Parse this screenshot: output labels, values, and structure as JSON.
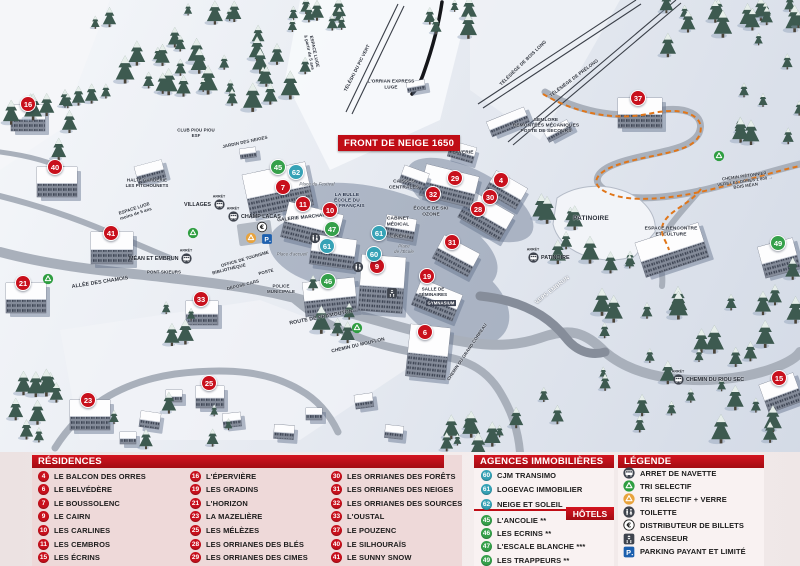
{
  "colors": {
    "residence": "#c8101c",
    "hotel": "#35a04a",
    "agency": "#36a2b6",
    "banner_red": "#c00d16",
    "parking_blue": "#1c5fae"
  },
  "map": {
    "banner": "FRONT DE NEIGE 1650",
    "bus_stop_microlabel": "ARRÊT",
    "markers": [
      {
        "n": "16",
        "t": "r",
        "x": 28,
        "y": 104
      },
      {
        "n": "40",
        "t": "r",
        "x": 55,
        "y": 167
      },
      {
        "n": "41",
        "t": "r",
        "x": 111,
        "y": 233
      },
      {
        "n": "21",
        "t": "r",
        "x": 23,
        "y": 283
      },
      {
        "n": "33",
        "t": "r",
        "x": 201,
        "y": 299
      },
      {
        "n": "23",
        "t": "r",
        "x": 88,
        "y": 400
      },
      {
        "n": "25",
        "t": "r",
        "x": 209,
        "y": 383
      },
      {
        "n": "7",
        "t": "r",
        "x": 283,
        "y": 187
      },
      {
        "n": "11",
        "t": "r",
        "x": 303,
        "y": 204
      },
      {
        "n": "10",
        "t": "r",
        "x": 330,
        "y": 210
      },
      {
        "n": "9",
        "t": "r",
        "x": 377,
        "y": 266
      },
      {
        "n": "32",
        "t": "r",
        "x": 433,
        "y": 194
      },
      {
        "n": "29",
        "t": "r",
        "x": 455,
        "y": 178
      },
      {
        "n": "4",
        "t": "r",
        "x": 501,
        "y": 180
      },
      {
        "n": "30",
        "t": "r",
        "x": 490,
        "y": 197
      },
      {
        "n": "28",
        "t": "r",
        "x": 478,
        "y": 209
      },
      {
        "n": "31",
        "t": "r",
        "x": 452,
        "y": 242
      },
      {
        "n": "19",
        "t": "r",
        "x": 427,
        "y": 276
      },
      {
        "n": "6",
        "t": "r",
        "x": 425,
        "y": 332
      },
      {
        "n": "37",
        "t": "r",
        "x": 638,
        "y": 98
      },
      {
        "n": "15",
        "t": "r",
        "x": 779,
        "y": 378
      },
      {
        "n": "45",
        "t": "g",
        "x": 278,
        "y": 167
      },
      {
        "n": "47",
        "t": "g",
        "x": 332,
        "y": 229
      },
      {
        "n": "46",
        "t": "g",
        "x": 328,
        "y": 281
      },
      {
        "n": "49",
        "t": "g",
        "x": 778,
        "y": 243
      },
      {
        "n": "62",
        "t": "b",
        "x": 296,
        "y": 172
      },
      {
        "n": "61",
        "t": "b",
        "x": 327,
        "y": 246
      },
      {
        "n": "61",
        "t": "b",
        "x": 379,
        "y": 233
      },
      {
        "n": "60",
        "t": "b",
        "x": 374,
        "y": 254
      }
    ],
    "labels": [
      {
        "t": "TÉLÉSKI DU PIC VERT",
        "x": 357,
        "y": 68,
        "r": -63,
        "fs": 4.6
      },
      {
        "t": "L'ORRIAN EXPRESS\nLUGE",
        "x": 391,
        "y": 84,
        "fs": 4.6
      },
      {
        "t": "TÉLÉSIÈGE DE BOIS LONG",
        "x": 523,
        "y": 63,
        "r": -44,
        "fs": 4.6
      },
      {
        "t": "TÉLÉSIÈGE DE PRÉLONG",
        "x": 574,
        "y": 78,
        "r": -37,
        "fs": 4.6
      },
      {
        "t": "SEMLORE\nREMONTÉES MÉCANIQUES\nPOSTE DE SECOURS",
        "x": 546,
        "y": 125,
        "fs": 4.8
      },
      {
        "t": "LAVERIE",
        "x": 463,
        "y": 152,
        "fs": 4.8
      },
      {
        "t": "CAISSES\nCENTRALES",
        "x": 404,
        "y": 184,
        "fs": 4.8
      },
      {
        "t": "ÉCOLE DE SKI\nOZONE",
        "x": 431,
        "y": 211,
        "fs": 4.8
      },
      {
        "t": "CABINET\nMÉDICAL",
        "x": 398,
        "y": 221,
        "fs": 4.8
      },
      {
        "t": "CINÉMA",
        "x": 400,
        "y": 236,
        "fs": 4.8
      },
      {
        "t": "Place\nde l'École",
        "x": 404,
        "y": 249,
        "fs": 4.4,
        "s": "it"
      },
      {
        "t": "LA BULLE\nÉCOLE DU\nSKI FRANÇAIS",
        "x": 347,
        "y": 200,
        "fs": 4.8,
        "s": "nv"
      },
      {
        "t": "Place du Festival",
        "x": 317,
        "y": 184,
        "fs": 4.4,
        "s": "it"
      },
      {
        "t": "GALERIE MARCHANDE",
        "x": 305,
        "y": 217,
        "r": -6,
        "fs": 4.8
      },
      {
        "t": "PONT SKIEURS",
        "x": 164,
        "y": 272,
        "fs": 4.4
      },
      {
        "t": "ALLÉE DES CHAMOIS",
        "x": 100,
        "y": 282,
        "r": -9,
        "fs": 5.2
      },
      {
        "t": "HALTE GARDERIE\nLES PITCHOUNETS",
        "x": 147,
        "y": 183,
        "fs": 4.4
      },
      {
        "t": "CLUB PIOU PIOU\nESF",
        "x": 196,
        "y": 133,
        "fs": 4.4
      },
      {
        "t": "JARDIN DES NEIGES",
        "x": 245,
        "y": 142,
        "r": -12,
        "fs": 4.4
      },
      {
        "t": "ESPACE LUGE\nà partir de 5 ans",
        "x": 312,
        "y": 52,
        "r": 78,
        "fs": 4.4
      },
      {
        "t": "ESPACE LUGE\nmoins de 5 ans",
        "x": 135,
        "y": 211,
        "r": -18,
        "fs": 4.4
      },
      {
        "t": "OFFICE DE TOURISME",
        "x": 245,
        "y": 259,
        "r": -16,
        "fs": 4.4
      },
      {
        "t": "BIBLIOTHÈQUE",
        "x": 229,
        "y": 269,
        "r": -14,
        "fs": 4.4
      },
      {
        "t": "POSTE",
        "x": 266,
        "y": 272,
        "r": -14,
        "fs": 4.4
      },
      {
        "t": "DÉPOSE CARS",
        "x": 243,
        "y": 285,
        "r": -14,
        "fs": 4.4
      },
      {
        "t": "POLICE\nMUNICIPALE",
        "x": 281,
        "y": 289,
        "fs": 4.4
      },
      {
        "t": "Place d'accueil",
        "x": 292,
        "y": 254,
        "fs": 4.4,
        "s": "it"
      },
      {
        "t": "ROUTE DE PRAMOUTON",
        "x": 321,
        "y": 317,
        "r": -11,
        "fs": 5.2
      },
      {
        "t": "CHEMIN DU MOUFLON",
        "x": 358,
        "y": 345,
        "r": -13,
        "fs": 4.8
      },
      {
        "t": "CHEMIN DU GRAND CORREAU",
        "x": 467,
        "y": 352,
        "r": -56,
        "fs": 4.4
      },
      {
        "t": "SALLE DE\nSÉMINAIRES",
        "x": 433,
        "y": 292,
        "fs": 4.4
      },
      {
        "t": "GYMNASIUM",
        "x": 441,
        "y": 303,
        "fs": 4.2,
        "s": "bd"
      },
      {
        "t": "PATINOIRE",
        "x": 591,
        "y": 218,
        "fs": 6.5
      },
      {
        "t": "ESPACE RENCONTRE\nET CULTURE",
        "x": 671,
        "y": 231,
        "fs": 4.8
      },
      {
        "t": "VERS EMBRUN",
        "x": 552,
        "y": 290,
        "r": -38,
        "fs": 5.5,
        "s": "wh"
      },
      {
        "t": "→",
        "x": 540,
        "y": 302,
        "r": 142,
        "fs": 8,
        "s": "wh"
      },
      {
        "t": "CHEMIN PIÉTONNIER\nVERS LES ORRES 1 800 →\nBOIS MÉAN",
        "x": 745,
        "y": 181,
        "r": -8,
        "fs": 4.2
      }
    ],
    "bus_stops": [
      {
        "label": "VILLAGES",
        "x": 219,
        "y": 204,
        "side": "left"
      },
      {
        "label": "CHAMP LACAS",
        "x": 233,
        "y": 216,
        "side": "right"
      },
      {
        "label": "MÉAN ET EMBRUN",
        "x": 186,
        "y": 258,
        "side": "left"
      },
      {
        "label": "PATINOIRE",
        "x": 533,
        "y": 257,
        "side": "right"
      },
      {
        "label": "CHEMIN DU RIOU SEC",
        "x": 678,
        "y": 379,
        "side": "right"
      }
    ],
    "icons": [
      {
        "n": "recycle-green-icon",
        "x": 193,
        "y": 233
      },
      {
        "n": "recycle-green-icon",
        "x": 48,
        "y": 279
      },
      {
        "n": "recycle-green-icon",
        "x": 357,
        "y": 328
      },
      {
        "n": "recycle-green-icon",
        "x": 719,
        "y": 156
      },
      {
        "n": "recycle-yellow-icon",
        "x": 251,
        "y": 238
      },
      {
        "n": "atm-euro-icon",
        "x": 262,
        "y": 227
      },
      {
        "n": "parking-icon",
        "x": 267,
        "y": 239
      },
      {
        "n": "toilets-icon",
        "x": 358,
        "y": 267
      },
      {
        "n": "toilets-icon",
        "x": 315,
        "y": 238
      },
      {
        "n": "elevator-icon",
        "x": 392,
        "y": 293
      }
    ]
  },
  "legend": {
    "residences": {
      "title": "RÉSIDENCES",
      "columns": [
        [
          {
            "n": "4",
            "name": "LE BALCON DES ORRES"
          },
          {
            "n": "6",
            "name": "LE BELVÉDÈRE"
          },
          {
            "n": "7",
            "name": "LE BOUSSOLENC"
          },
          {
            "n": "9",
            "name": "LE CAIRN"
          },
          {
            "n": "10",
            "name": "LES CARLINES"
          },
          {
            "n": "11",
            "name": "LES CEMBROS"
          },
          {
            "n": "15",
            "name": "LES ÉCRINS"
          }
        ],
        [
          {
            "n": "16",
            "name": "L'ÉPERVIÈRE"
          },
          {
            "n": "19",
            "name": "LES GRADINS"
          },
          {
            "n": "21",
            "name": "L'HORIZON"
          },
          {
            "n": "23",
            "name": "LA MAZELIÈRE"
          },
          {
            "n": "25",
            "name": "LES MÉLÈZES"
          },
          {
            "n": "28",
            "name": "LES ORRIANES DES BLÉS"
          },
          {
            "n": "29",
            "name": "LES ORRIANES DES CIMES"
          }
        ],
        [
          {
            "n": "30",
            "name": "LES ORRIANES DES FORÊTS"
          },
          {
            "n": "31",
            "name": "LES ORRIANES DES NEIGES"
          },
          {
            "n": "32",
            "name": "LES ORRIANES DES SOURCES"
          },
          {
            "n": "33",
            "name": "L'OUSTAL"
          },
          {
            "n": "37",
            "name": "LE POUZENC"
          },
          {
            "n": "40",
            "name": "LE SILHOURAÏS"
          },
          {
            "n": "41",
            "name": "LE SUNNY SNOW"
          }
        ]
      ]
    },
    "agences": {
      "title": "AGENCES IMMOBILIÈRES",
      "items": [
        {
          "n": "60",
          "name": "CJM TRANSIMO"
        },
        {
          "n": "61",
          "name": "LOGEVAC IMMOBILIER"
        },
        {
          "n": "62",
          "name": "NEIGE ET SOLEIL"
        }
      ]
    },
    "hotels": {
      "title": "HÔTELS",
      "items": [
        {
          "n": "45",
          "name": "L'ANCOLIE **"
        },
        {
          "n": "46",
          "name": "LES ECRINS **"
        },
        {
          "n": "47",
          "name": "L'ESCALE BLANCHE ***"
        },
        {
          "n": "49",
          "name": "LES TRAPPEURS **"
        }
      ]
    },
    "legende": {
      "title": "LÉGENDE",
      "items": [
        {
          "icon": "shuttle-bus-icon",
          "name": "ARRET DE NAVETTE"
        },
        {
          "icon": "recycle-green-icon",
          "name": "TRI SELECTIF"
        },
        {
          "icon": "recycle-yellow-icon",
          "name": "TRI SELECTIF + VERRE"
        },
        {
          "icon": "toilets-icon",
          "name": "TOILETTE"
        },
        {
          "icon": "atm-euro-icon",
          "name": "DISTRIBUTEUR DE BILLETS"
        },
        {
          "icon": "elevator-icon",
          "name": "ASCENSEUR"
        },
        {
          "icon": "parking-icon",
          "name": "PARKING PAYANT ET LIMITÉ"
        }
      ]
    }
  }
}
